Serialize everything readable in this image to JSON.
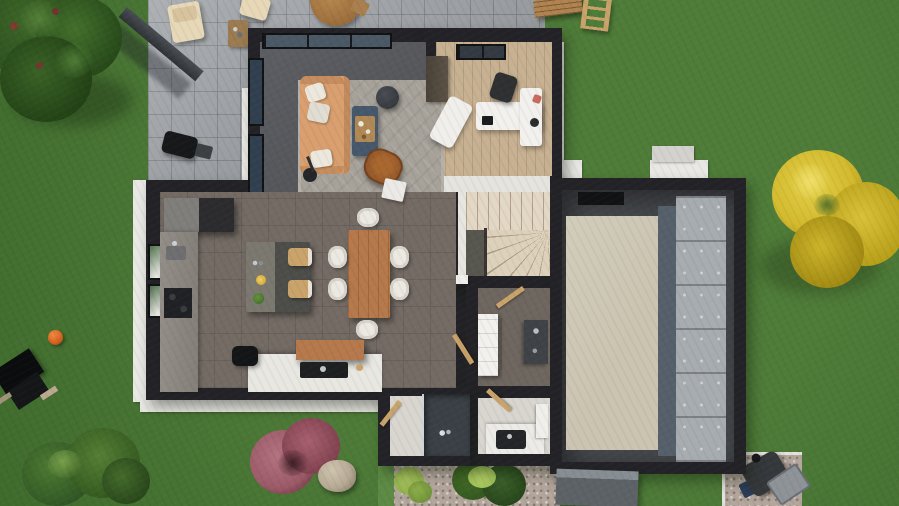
{
  "meta": {
    "title": "Top-down 3D render of a house ground-floor plan with garden",
    "canvas": {
      "width": 899,
      "height": 506
    },
    "visible_text": "none"
  },
  "palette": {
    "grass": "#4f7c39",
    "grass_dark": "#3f6b2d",
    "paver": "#a2a6aa",
    "wall": "#232327",
    "white_wall": "#e9e8e4",
    "living_floor": "#56575b",
    "kitchen_floor": "#746b64",
    "rug": "#a6a29a",
    "sofa": "#d99f6f",
    "pillow": "#ece8de",
    "coffee_table": "#46586b",
    "wood": "#b5794c",
    "wood_light": "#c9a36a",
    "leather": "#8f5429",
    "office_floor": "#c7b192",
    "desk_white": "#f2f1ee",
    "chair_dark": "#2f3032",
    "stairs": "#e3d8c5",
    "garage_floor": "#45484c",
    "garage_slab": "#cbc4b1",
    "garage_door": "#b0b5ba",
    "garage_band": "#55606b",
    "glass": "#31404f",
    "glass_light": "#4b5866",
    "counter_gray": "#928e87",
    "island": "#55554f",
    "appliance_dark": "#1c1d1f",
    "counter_white": "#e9e7e2",
    "room_floor": "#d9d6d0",
    "utility_floor": "#6e665f",
    "shower_tray": "#3a4046",
    "gravel": "#b3a69c",
    "plant_light": "#8fae4a",
    "bush_green": "#34571f",
    "bush_pink": "#9c5a68",
    "tree_dark": "#2c4f1e",
    "tree_yellow": "#d3ba2e",
    "ball_orange": "#d9641f",
    "bin_gray": "#35383b",
    "bin_lid": "#8e9397",
    "canopy": "#5d6267",
    "rock": "#b6aa95",
    "cream": "#e7d8b8"
  },
  "scene": {
    "rooms": [
      {
        "name": "living-room",
        "furniture": [
          "tan-sofa",
          "white-pillows",
          "area-rug",
          "coffee-table",
          "round-pouf",
          "butterfly-chair",
          "floor-lamp",
          "side-table",
          "corner-glazing",
          "west-windows"
        ]
      },
      {
        "name": "office",
        "furniture": [
          "l-shaped-white-desk",
          "office-chair",
          "wardrobe",
          "white-lounge-chair",
          "skylight"
        ]
      },
      {
        "name": "kitchen-dining",
        "furniture": [
          "fridge-column",
          "counter-with-sink",
          "cooktop",
          "kitchen-island",
          "two-bar-stools",
          "dining-table",
          "six-white-chairs",
          "white-counter",
          "wood-wall-cabinet",
          "black-appliance"
        ]
      },
      {
        "name": "stair-hall",
        "furniture": [
          "winder-staircase",
          "radiator"
        ]
      },
      {
        "name": "utility-room",
        "furniture": [
          "white-fridge-freezer",
          "dark-counter",
          "open-wood-door"
        ]
      },
      {
        "name": "shower-room",
        "furniture": [
          "dark-shower-tray",
          "open-wood-door"
        ]
      },
      {
        "name": "wc",
        "furniture": [
          "washbasin-counter",
          "dark-sink",
          "boiler",
          "open-wood-door"
        ]
      },
      {
        "name": "garage",
        "furniture": [
          "beige-floor-slab",
          "sectional-garage-door",
          "skylight-strip"
        ]
      }
    ],
    "garden": [
      "stone-paver-patio",
      "pergola-beam",
      "bbq-grill",
      "two-cream-lounge-chairs",
      "wood-side-table",
      "round-wood-table",
      "wood-bench",
      "wood-ladder",
      "large-green-tree",
      "yellow-tree",
      "orange-ball",
      "black-garden-furniture",
      "green-bush",
      "pink-bush",
      "rock",
      "gravel-path-with-shrubs",
      "gravel-pad",
      "wheelie-bin",
      "entrance-canopy",
      "lawn"
    ]
  }
}
